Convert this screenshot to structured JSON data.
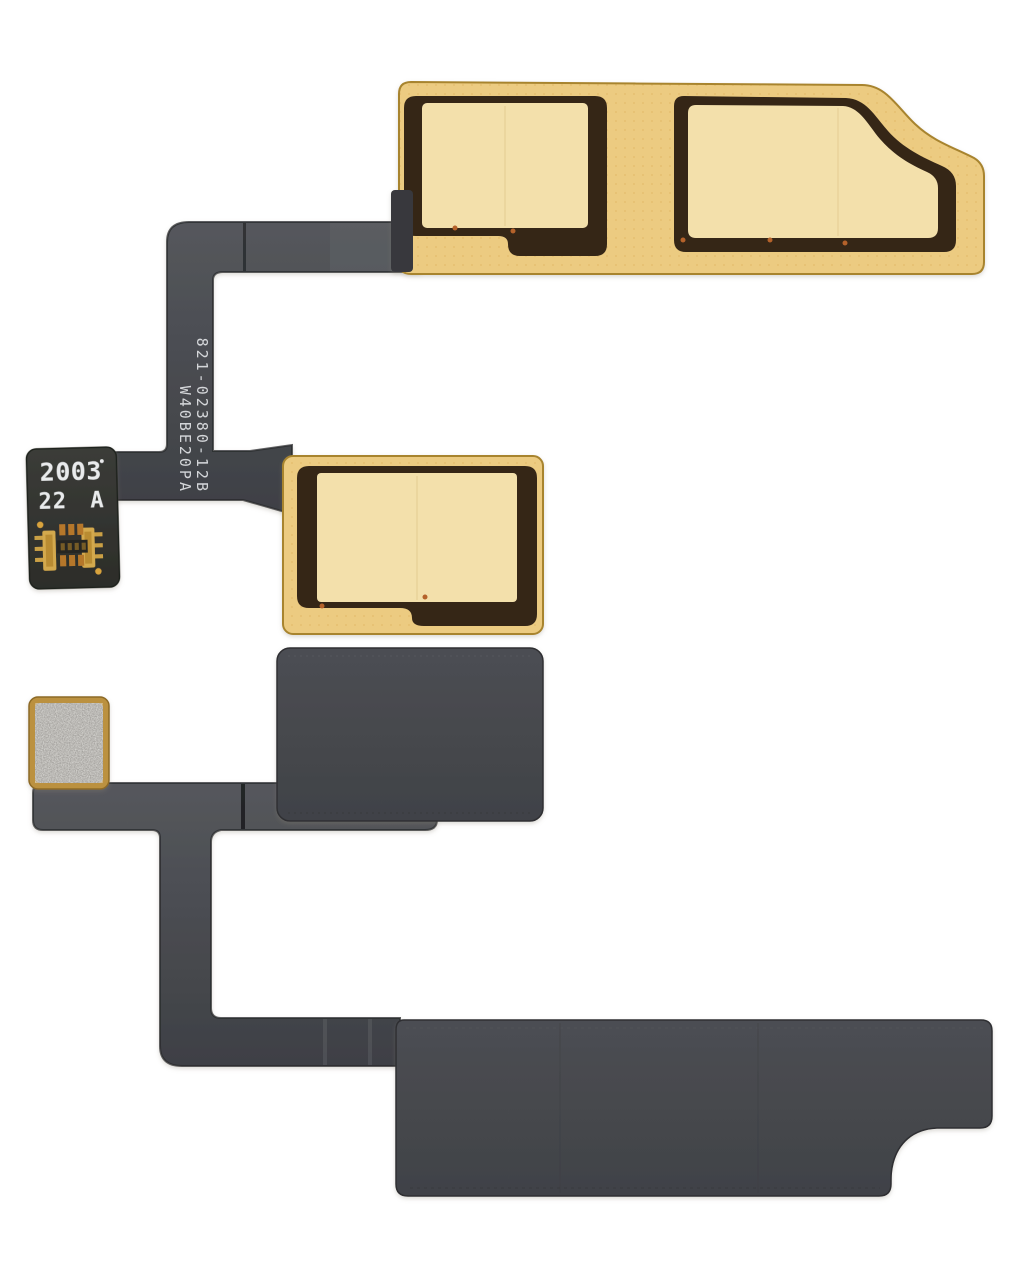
{
  "image": {
    "background_color": "#ffffff",
    "subject": "smartphone-antenna-flex-cable"
  },
  "part_markings": {
    "part_number": "821-02380-12B",
    "lot_code": "W40BE20PA",
    "label_line1": "2003",
    "label_dot": "•",
    "label_line2": "22 A"
  },
  "colors": {
    "kapton_gold": "#eccb81",
    "pad_light_gold": "#f3e0ab",
    "inset_dark_brown": "#342619",
    "ribbon_gray": "#47494e",
    "stiffener_gray": "#46484d",
    "foam_pad_silver": "#a6a4a0",
    "foam_pad_border_gold": "#bb913f",
    "label_black": "#33342f",
    "marking_white": "#e4e5e7",
    "connector_gold": "#d2a348",
    "via_orange": "#c2762d"
  }
}
